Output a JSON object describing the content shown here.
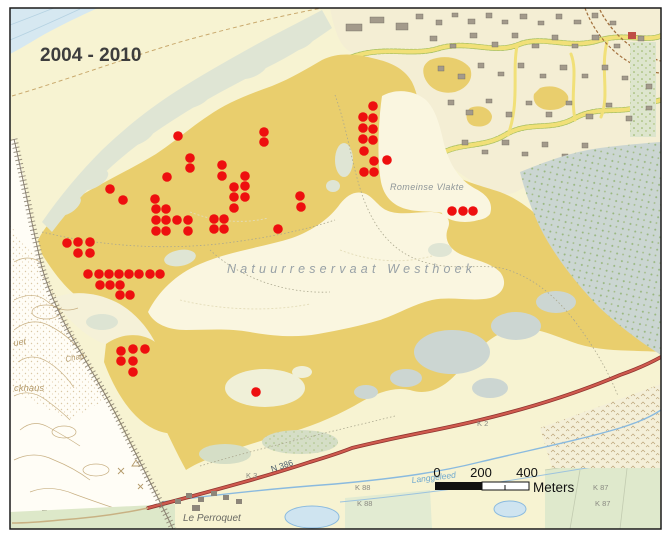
{
  "title": "2004 - 2010",
  "map": {
    "labels": {
      "reserve": "Natuurreservaat Westhoek",
      "plain": "Romeinse Vlakte",
      "hamlet": "Le Perroquet",
      "stream": "Langgeleed",
      "road": "N 386",
      "k3": "K 3",
      "k2": "K 2",
      "k88": "K 88",
      "k87": "K 87",
      "partial_uet": "uet",
      "partial_ckhaus": "ckhaus",
      "partial_chap": "Chap"
    },
    "scalebar": {
      "tick0": "0",
      "tick200": "200",
      "tick400": "400",
      "unit": "Meters"
    },
    "dot_style": {
      "color": "#ee0f0f",
      "radius": 4.8
    },
    "colors": {
      "dune_ochre": "#e9ce6d",
      "beach_cream": "#f7f3d2",
      "sea_blue": "#d6e8f1",
      "open_sand": "#faf6e0",
      "scrub_green": "#dfe5d4",
      "woods_gray": "#cbd6d2",
      "road_red": "#c2544a",
      "water_blue": "#8abadf",
      "title_text": "#3d3d3d",
      "reserve_label": "#98a1a6"
    },
    "dots": [
      [
        178,
        136
      ],
      [
        264,
        132
      ],
      [
        264,
        142
      ],
      [
        190,
        158
      ],
      [
        190,
        168
      ],
      [
        222,
        165
      ],
      [
        222,
        176
      ],
      [
        167,
        177
      ],
      [
        245,
        176
      ],
      [
        234,
        187
      ],
      [
        245,
        186
      ],
      [
        234,
        197
      ],
      [
        245,
        197
      ],
      [
        234,
        208
      ],
      [
        110,
        189
      ],
      [
        123,
        200
      ],
      [
        155,
        199
      ],
      [
        300,
        196
      ],
      [
        301,
        207
      ],
      [
        278,
        229
      ],
      [
        156,
        209
      ],
      [
        166,
        209
      ],
      [
        156,
        220
      ],
      [
        166,
        220
      ],
      [
        177,
        220
      ],
      [
        188,
        220
      ],
      [
        156,
        231
      ],
      [
        166,
        231
      ],
      [
        188,
        231
      ],
      [
        214,
        219
      ],
      [
        224,
        219
      ],
      [
        214,
        229
      ],
      [
        224,
        229
      ],
      [
        67,
        243
      ],
      [
        78,
        242
      ],
      [
        90,
        242
      ],
      [
        78,
        253
      ],
      [
        90,
        253
      ],
      [
        88,
        274
      ],
      [
        99,
        274
      ],
      [
        109,
        274
      ],
      [
        119,
        274
      ],
      [
        129,
        274
      ],
      [
        139,
        274
      ],
      [
        150,
        274
      ],
      [
        160,
        274
      ],
      [
        100,
        285
      ],
      [
        110,
        285
      ],
      [
        120,
        285
      ],
      [
        120,
        295
      ],
      [
        130,
        295
      ],
      [
        373,
        106
      ],
      [
        363,
        117
      ],
      [
        373,
        118
      ],
      [
        363,
        128
      ],
      [
        373,
        129
      ],
      [
        363,
        139
      ],
      [
        373,
        140
      ],
      [
        364,
        151
      ],
      [
        374,
        161
      ],
      [
        387,
        160
      ],
      [
        364,
        172
      ],
      [
        374,
        172
      ],
      [
        452,
        211
      ],
      [
        463,
        211
      ],
      [
        473,
        211
      ],
      [
        121,
        351
      ],
      [
        133,
        349
      ],
      [
        145,
        349
      ],
      [
        121,
        361
      ],
      [
        133,
        361
      ],
      [
        133,
        372
      ],
      [
        256,
        392
      ]
    ]
  }
}
